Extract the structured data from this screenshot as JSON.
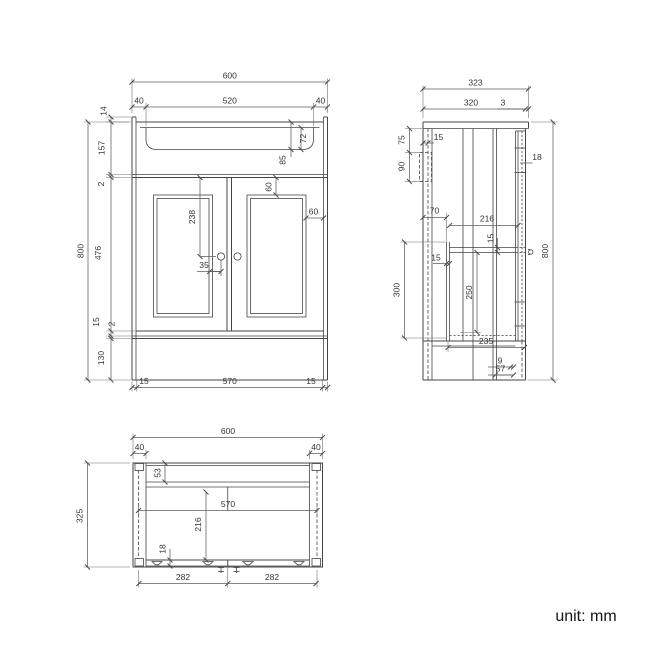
{
  "drawing": {
    "views": {
      "front": {
        "dims": {
          "overall_width": "600",
          "rim_left": "40",
          "basin_width": "520",
          "rim_right": "40",
          "upstand_height": "14",
          "counter_zone_height": "157",
          "gap_top": "2",
          "door_height": "476",
          "bottom_rail": "15",
          "gap_bottom": "2",
          "plinth_height": "130",
          "overall_height": "800",
          "basin_depth_inner": "72",
          "basin_depth_outer": "85",
          "panel_inset_top": "60",
          "panel_inset_side": "60",
          "handle_from_top": "238",
          "handle_offset": "35",
          "base_left": "15",
          "base_width": "570",
          "base_right": "15"
        }
      },
      "side": {
        "dims": {
          "overall_depth": "323",
          "top_depth": "320",
          "front_lip": "3",
          "bracket_from_top": "75",
          "bracket_height": "90",
          "bracket_inset": "15",
          "door_thickness": "18",
          "back_inset": "70",
          "shelf_depth": "216",
          "shelf_thickness": "15",
          "support_inset": "15",
          "support_height": "300",
          "shelf_clearance": "250",
          "base_depth": "235",
          "toe_lip": "9",
          "toe_depth": "57",
          "overall_height": "800"
        }
      },
      "plan": {
        "dims": {
          "overall_width": "600",
          "side_panel_left": "40",
          "side_panel_right": "40",
          "back_rail_depth": "53",
          "inner_width": "570",
          "inner_depth": "216",
          "door_thickness": "18",
          "door_width_left": "282",
          "door_width_right": "282",
          "overall_depth": "325"
        }
      }
    },
    "footer": {
      "unit_label": "unit: mm"
    }
  }
}
